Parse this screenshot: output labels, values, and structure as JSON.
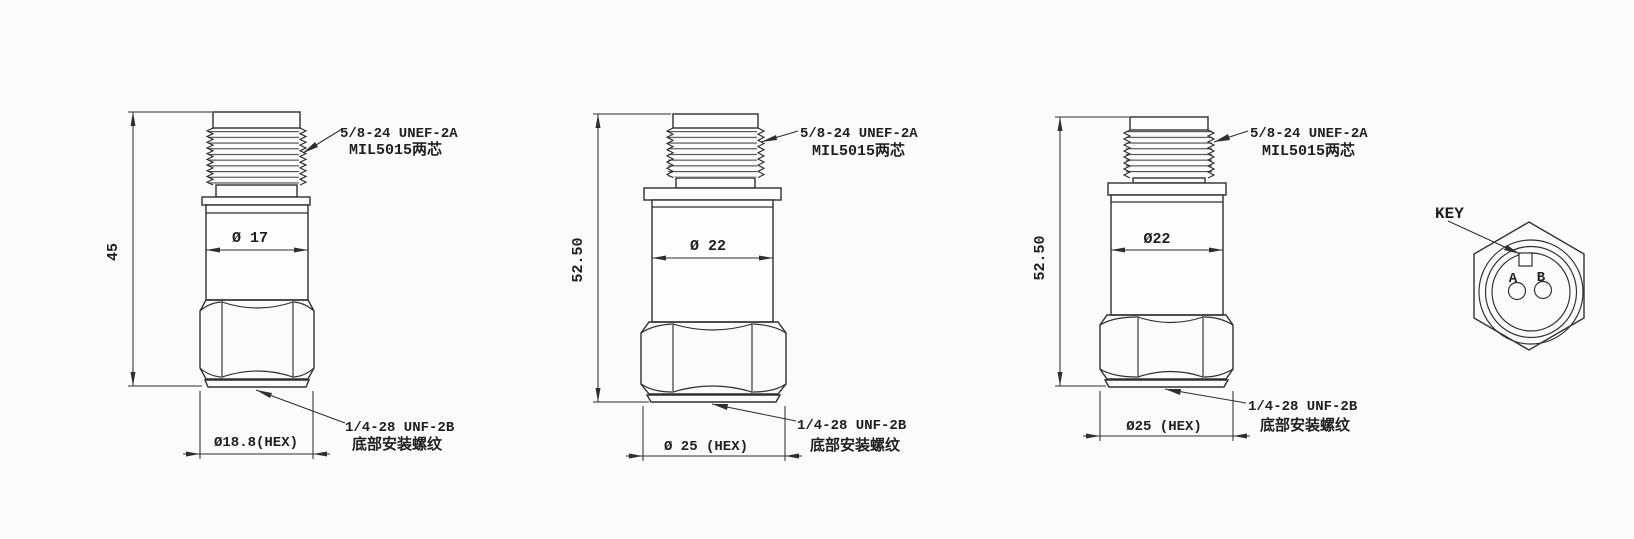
{
  "canvas": {
    "background": "#fbfbfb",
    "ink": "#2f2f2f"
  },
  "views": [
    {
      "height_dim": "45",
      "body_dia_dim": "Ø 17",
      "hex_dim": "Ø18.8(HEX)",
      "top_thread_label": [
        "5/8-24 UNEF-2A",
        "MIL5015两芯"
      ],
      "bottom_thread_label": [
        "1/4-28 UNF-2B",
        "底部安装螺纹"
      ]
    },
    {
      "height_dim": "52.50",
      "body_dia_dim": "Ø 22",
      "hex_dim": "Ø 25 (HEX)",
      "top_thread_label": [
        "5/8-24 UNEF-2A",
        "MIL5015两芯"
      ],
      "bottom_thread_label": [
        "1/4-28 UNF-2B",
        "底部安装螺纹"
      ]
    },
    {
      "height_dim": "52.50",
      "body_dia_dim": "Ø22",
      "hex_dim": "Ø25 (HEX)",
      "top_thread_label": [
        "5/8-24 UNEF-2A",
        "MIL5015两芯"
      ],
      "bottom_thread_label": [
        "1/4-28 UNF-2B",
        "底部安装螺纹"
      ]
    }
  ],
  "connector_view": {
    "key_label": "KEY",
    "pin_labels": [
      "A",
      "B"
    ]
  }
}
